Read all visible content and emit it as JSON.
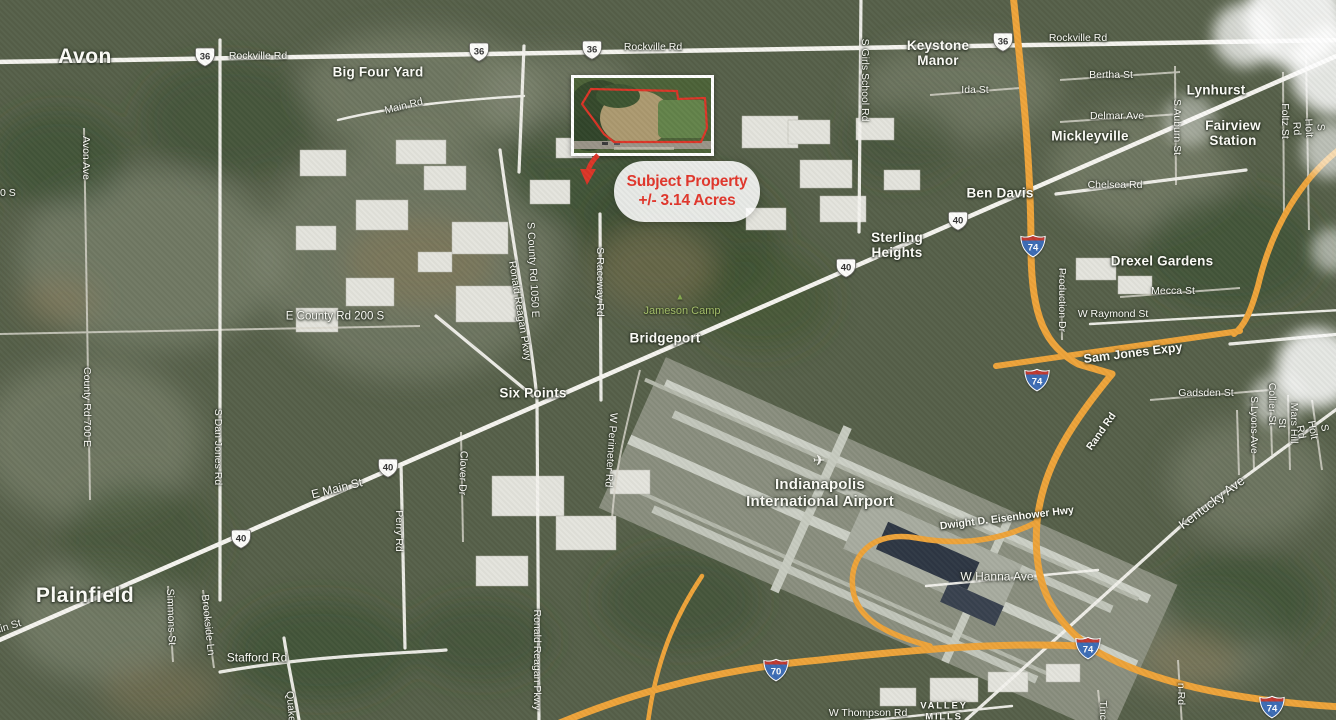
{
  "map": {
    "callout": {
      "line1": "Subject Property",
      "line2": "+/- 3.14 Acres",
      "accent_color": "#e2362b"
    },
    "inset": {
      "outline_color": "#dc3527"
    },
    "colors": {
      "highway_orange": "#eea43a",
      "road_white": "#f4f3ee"
    },
    "labels": [
      {
        "t": "Avon",
        "x": 85,
        "y": 57,
        "c": "place-lg",
        "n": "place-label-avon"
      },
      {
        "t": "Rockville Rd",
        "x": 258,
        "y": 57,
        "c": "road",
        "n": "road-label-rockville-rd-west"
      },
      {
        "t": "Big Four Yard",
        "x": 378,
        "y": 72,
        "c": "place",
        "n": "place-label-big-four-yard"
      },
      {
        "t": "Main Rd",
        "x": 404,
        "y": 107,
        "r": -14,
        "c": "road",
        "n": "road-label-main-rd"
      },
      {
        "t": "Rockville Rd",
        "x": 653,
        "y": 48,
        "c": "road",
        "n": "road-label-rockville-rd-center"
      },
      {
        "t": "Rockville Rd",
        "x": 1078,
        "y": 39,
        "c": "road",
        "n": "road-label-rockville-rd-east"
      },
      {
        "t": "Keystone\nManor",
        "x": 938,
        "y": 53,
        "c": "place",
        "n": "place-label-keystone-manor"
      },
      {
        "t": "S Girls School Rd",
        "x": 864,
        "y": 80,
        "r": 90,
        "c": "road",
        "n": "road-label-s-girls-school-rd"
      },
      {
        "t": "Bertha St",
        "x": 1111,
        "y": 76,
        "c": "road",
        "n": "road-label-bertha-st"
      },
      {
        "t": "Ida St",
        "x": 975,
        "y": 91,
        "c": "road",
        "n": "road-label-ida-st"
      },
      {
        "t": "Delmar Ave",
        "x": 1117,
        "y": 117,
        "c": "road",
        "n": "road-label-delmar-ave"
      },
      {
        "t": "Mickleyville",
        "x": 1090,
        "y": 136,
        "c": "place",
        "n": "place-label-mickleyville"
      },
      {
        "t": "Lynhurst",
        "x": 1216,
        "y": 90,
        "c": "place",
        "n": "place-label-lynhurst"
      },
      {
        "t": "Fairview\nStation",
        "x": 1233,
        "y": 133,
        "c": "place",
        "n": "place-label-fairview-station"
      },
      {
        "t": "S Auburn St",
        "x": 1176,
        "y": 127,
        "r": 90,
        "c": "road",
        "n": "road-label-s-auburn-st"
      },
      {
        "t": "Foltz St",
        "x": 1284,
        "y": 121,
        "r": 90,
        "c": "road",
        "n": "road-label-foltz-st"
      },
      {
        "t": "S Holt Rd",
        "x": 1308,
        "y": 128,
        "r": 87,
        "c": "road",
        "n": "road-label-s-holt-rd-north"
      },
      {
        "t": "Chelsea Rd",
        "x": 1115,
        "y": 186,
        "c": "road",
        "n": "road-label-chelsea-rd"
      },
      {
        "t": "Ben Davis",
        "x": 1000,
        "y": 193,
        "c": "place",
        "n": "place-label-ben-davis"
      },
      {
        "t": "Sterling\nHeights",
        "x": 897,
        "y": 245,
        "c": "place",
        "n": "place-label-sterling-heights"
      },
      {
        "t": "Drexel Gardens",
        "x": 1162,
        "y": 261,
        "c": "place",
        "n": "place-label-drexel-gardens"
      },
      {
        "t": "Production Dr",
        "x": 1061,
        "y": 300,
        "r": 90,
        "c": "road",
        "n": "road-label-production-dr"
      },
      {
        "t": "Mecca St",
        "x": 1173,
        "y": 292,
        "c": "road",
        "n": "road-label-mecca-st"
      },
      {
        "t": "W Raymond St",
        "x": 1113,
        "y": 315,
        "c": "road",
        "n": "road-label-w-raymond-st"
      },
      {
        "t": "E County Rd 200 S",
        "x": 335,
        "y": 317,
        "c": "road",
        "s": 11.5,
        "n": "road-label-e-county-rd-200-s"
      },
      {
        "t": "S County Rd 1050 E",
        "x": 532,
        "y": 270,
        "r": 87,
        "c": "road",
        "n": "road-label-s-county-rd-1050-e"
      },
      {
        "t": "Ronald Reagan Pkwy",
        "x": 519,
        "y": 311,
        "r": 81,
        "c": "road",
        "n": "road-label-ronald-reagan-pkwy-north"
      },
      {
        "t": "S Raceway Rd",
        "x": 599,
        "y": 282,
        "r": 90,
        "c": "road",
        "n": "road-label-s-raceway-rd"
      },
      {
        "t": "Jameson Camp",
        "x": 682,
        "y": 311,
        "c": "green",
        "n": "poi-label-jameson-camp"
      },
      {
        "t": "Bridgeport",
        "x": 665,
        "y": 338,
        "c": "place",
        "n": "place-label-bridgeport"
      },
      {
        "t": "Six Points",
        "x": 533,
        "y": 393,
        "c": "place",
        "n": "place-label-six-points"
      },
      {
        "t": "Sam Jones Expy",
        "x": 1133,
        "y": 353,
        "r": -7,
        "c": "road",
        "s": 12.5,
        "b": 1,
        "n": "road-label-sam-jones-expy"
      },
      {
        "t": "Gadsden St",
        "x": 1206,
        "y": 394,
        "c": "road",
        "n": "road-label-gadsden-st"
      },
      {
        "t": "Collier St",
        "x": 1271,
        "y": 404,
        "r": 90,
        "c": "road",
        "n": "road-label-collier-st"
      },
      {
        "t": "S Lyons Ave",
        "x": 1253,
        "y": 425,
        "r": 90,
        "c": "road",
        "n": "road-label-s-lyons-ave"
      },
      {
        "t": "Mars Hill St",
        "x": 1287,
        "y": 423,
        "r": 90,
        "c": "road",
        "n": "road-label-mars-hill-st"
      },
      {
        "t": "S Holt Rd",
        "x": 1312,
        "y": 430,
        "r": 80,
        "c": "road",
        "n": "road-label-s-holt-rd-south"
      },
      {
        "t": "Rand Rd",
        "x": 1102,
        "y": 432,
        "r": -55,
        "c": "road",
        "b": 1,
        "n": "road-label-rand-rd"
      },
      {
        "t": "W Perimeter Rd",
        "x": 610,
        "y": 450,
        "r": 94,
        "c": "road",
        "n": "road-label-w-perimeter-rd"
      },
      {
        "t": "Clover Dr",
        "x": 462,
        "y": 473,
        "r": 92,
        "c": "road",
        "n": "road-label-clover-dr"
      },
      {
        "t": "E Main St",
        "x": 337,
        "y": 489,
        "r": -14,
        "c": "road",
        "s": 12,
        "n": "road-label-e-main-st"
      },
      {
        "t": "Perry Rd",
        "x": 398,
        "y": 531,
        "r": 90,
        "c": "road",
        "n": "road-label-perry-rd"
      },
      {
        "t": "Kentucky Ave",
        "x": 1212,
        "y": 503,
        "r": -37,
        "c": "road",
        "s": 13,
        "n": "road-label-kentucky-ave"
      },
      {
        "t": "Dwight D. Eisenhower Hwy",
        "x": 1007,
        "y": 519,
        "r": -7,
        "c": "road",
        "b": 1,
        "n": "road-label-dwight-d-eisenhower-hwy"
      },
      {
        "t": "W Hanna Ave",
        "x": 997,
        "y": 577,
        "c": "road",
        "s": 12,
        "n": "road-label-w-hanna-ave"
      },
      {
        "t": "Indianapolis\nInternational Airport",
        "x": 820,
        "y": 494,
        "c": "place",
        "s": 15,
        "n": "place-label-indianapolis-international-airport"
      },
      {
        "t": "Plainfield",
        "x": 85,
        "y": 596,
        "c": "place-lg",
        "n": "place-label-plainfield"
      },
      {
        "t": "Main St",
        "x": 4,
        "y": 629,
        "r": -17,
        "c": "road",
        "n": "road-label-main-st-fragment"
      },
      {
        "t": "Simmons St",
        "x": 170,
        "y": 617,
        "r": 88,
        "c": "road",
        "n": "road-label-simmons-st"
      },
      {
        "t": "Brookside Ln",
        "x": 207,
        "y": 625,
        "r": 84,
        "c": "road",
        "n": "road-label-brookside-ln"
      },
      {
        "t": "Stafford Rd",
        "x": 257,
        "y": 658,
        "c": "road",
        "s": 12,
        "n": "road-label-stafford-rd"
      },
      {
        "t": "Quaker Blvd",
        "x": 291,
        "y": 720,
        "r": 85,
        "c": "road",
        "n": "road-label-quaker-blvd-fragment"
      },
      {
        "t": "Ronald Reagan Pkwy",
        "x": 536,
        "y": 660,
        "r": 90,
        "c": "road",
        "n": "road-label-ronald-reagan-pkwy-south"
      },
      {
        "t": "W Thompson Rd",
        "x": 868,
        "y": 714,
        "c": "road",
        "n": "road-label-w-thompson-rd"
      },
      {
        "t": "VALLEY\nMILLS",
        "x": 944,
        "y": 712,
        "c": "caps",
        "n": "place-label-valley-mills"
      },
      {
        "t": "Tincher Rd",
        "x": 1102,
        "y": 726,
        "r": 90,
        "c": "road",
        "n": "road-label-tincher-rd-fragment"
      },
      {
        "t": "n Rd",
        "x": 1180,
        "y": 694,
        "r": 90,
        "c": "road",
        "n": "road-label-fragment-n-rd"
      },
      {
        "t": "700 S",
        "x": 2,
        "y": 194,
        "c": "road",
        "n": "road-label-700-s-fragment"
      },
      {
        "t": "Avon Ave",
        "x": 85,
        "y": 158,
        "r": 90,
        "c": "road",
        "n": "road-label-avon-ave"
      },
      {
        "t": "County Rd 700 E",
        "x": 86,
        "y": 407,
        "r": 90,
        "c": "road",
        "n": "road-label-county-rd-700-e"
      },
      {
        "t": "S Dan Jones Rd",
        "x": 217,
        "y": 447,
        "r": 90,
        "c": "road",
        "n": "road-label-s-dan-jones-rd"
      }
    ],
    "shields": [
      {
        "t": "us",
        "n": "36",
        "x": 205,
        "y": 57
      },
      {
        "t": "us",
        "n": "36",
        "x": 479,
        "y": 52
      },
      {
        "t": "us",
        "n": "36",
        "x": 592,
        "y": 50
      },
      {
        "t": "us",
        "n": "36",
        "x": 1003,
        "y": 42
      },
      {
        "t": "us",
        "n": "40",
        "x": 958,
        "y": 221
      },
      {
        "t": "us",
        "n": "40",
        "x": 846,
        "y": 268
      },
      {
        "t": "us",
        "n": "40",
        "x": 388,
        "y": 468
      },
      {
        "t": "us",
        "n": "40",
        "x": 241,
        "y": 539
      },
      {
        "t": "i",
        "n": "74",
        "x": 1033,
        "y": 246
      },
      {
        "t": "i",
        "n": "74",
        "x": 1037,
        "y": 380
      },
      {
        "t": "i",
        "n": "74",
        "x": 1088,
        "y": 648
      },
      {
        "t": "i",
        "n": "74",
        "x": 1272,
        "y": 707
      },
      {
        "t": "i",
        "n": "70",
        "x": 776,
        "y": 670
      }
    ],
    "icons": [
      {
        "name": "airplane-icon",
        "glyph": "✈",
        "x": 819,
        "y": 461,
        "s": 15,
        "color": "#f6f6f1"
      },
      {
        "name": "campground-icon",
        "glyph": "▲",
        "x": 680,
        "y": 297,
        "s": 9,
        "color": "#85a94e"
      }
    ]
  }
}
